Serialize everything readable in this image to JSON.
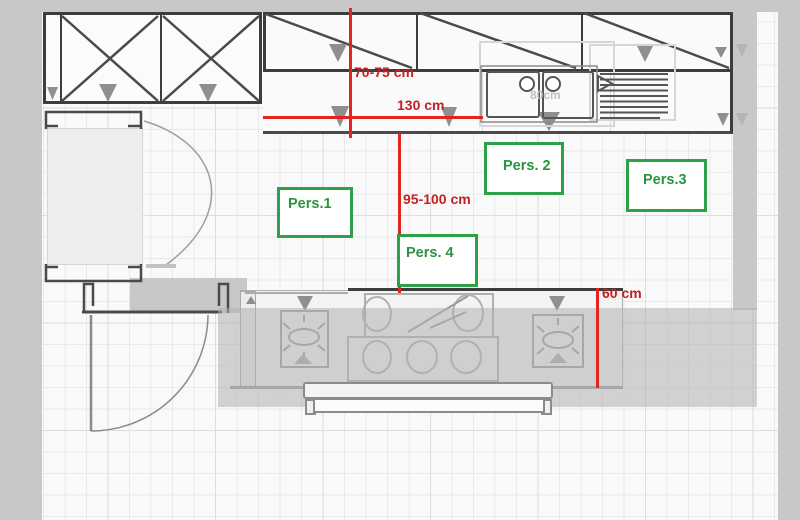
{
  "meta": {
    "type": "kitchen floor plan with clearance annotations"
  },
  "dimensions": [
    {
      "id": "upper-cabinet-clearance",
      "label": "70-75 cm"
    },
    {
      "id": "counter-run-width",
      "label": "130 cm"
    },
    {
      "id": "walkway-clearance",
      "label": "95-100 cm"
    },
    {
      "id": "island-clearance",
      "label": "60 cm"
    }
  ],
  "persons": [
    {
      "id": "person-1",
      "label": "Pers.1"
    },
    {
      "id": "person-2",
      "label": "Pers. 2"
    },
    {
      "id": "person-3",
      "label": "Pers.3"
    },
    {
      "id": "person-4",
      "label": "Pers. 4"
    }
  ],
  "watermarks": {
    "sink_width": "80cm"
  },
  "colors": {
    "dimension_line": "#e52322",
    "dimension_text": "#c4201f",
    "person_border": "#2da04a",
    "person_text": "#2b9440",
    "outside_gray": "#c8c8c8",
    "highlight_overlay": "rgba(176,176,176,0.55)",
    "cabinet_line": "#3d3d3d"
  }
}
